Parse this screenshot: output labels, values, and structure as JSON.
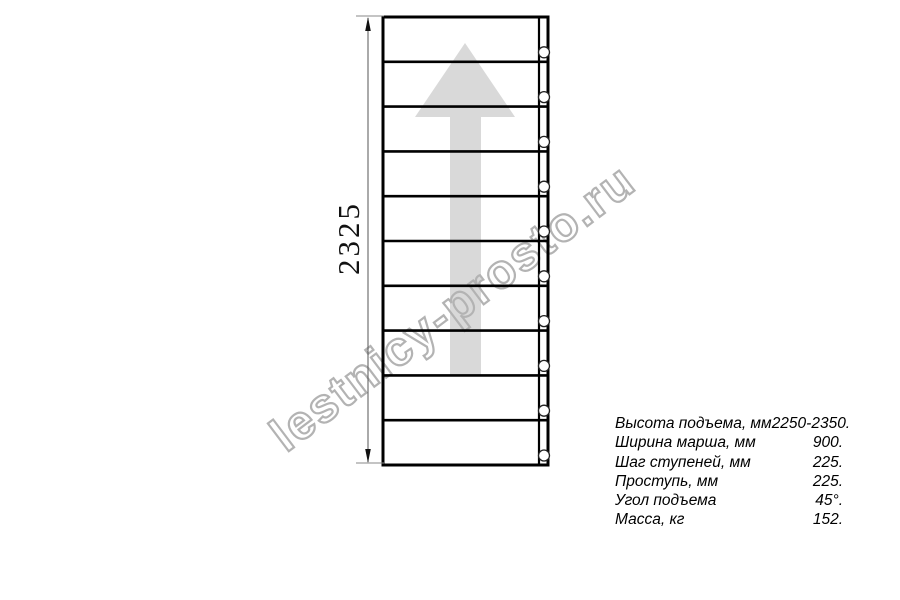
{
  "drawing": {
    "dimension_label": "2325",
    "steps": 10,
    "line_color": "#000000",
    "arrow_color": "#d9d9d9",
    "geometry": {
      "left": 383,
      "right": 548,
      "top": 17,
      "bottom": 465,
      "stringer_x": 539,
      "bolt_cx": 544,
      "bolt_r": 5.5
    }
  },
  "watermark": {
    "text": "lestnicy-prosto.ru",
    "color": "#b3b3b3"
  },
  "specs": {
    "rows": [
      {
        "label": "Высота подъема, мм",
        "value": "2250-2350."
      },
      {
        "label": "Ширина марша, мм",
        "value": "900."
      },
      {
        "label": "Шаг ступеней, мм",
        "value": "225."
      },
      {
        "label": "Проступь, мм",
        "value": "225."
      },
      {
        "label": "Угол подъема",
        "value": "45°."
      },
      {
        "label": "Масса, кг",
        "value": "152."
      }
    ]
  }
}
